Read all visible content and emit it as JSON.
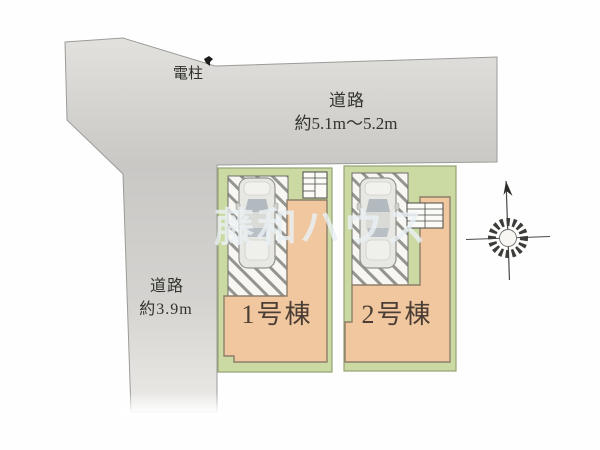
{
  "plan": {
    "type": "real-estate-site-plan",
    "watermark": {
      "text": "藤和ハウス"
    },
    "roads": {
      "top": {
        "label": "道路",
        "width_label": "約5.1m〜5.2m"
      },
      "left": {
        "label": "道路",
        "width_label": "約3.9m"
      }
    },
    "landmarks": {
      "utility_pole": {
        "label": "電柱"
      }
    },
    "lots": [
      {
        "name": "1号棟",
        "features": [
          "building",
          "parking-space",
          "car",
          "entrance-steps"
        ]
      },
      {
        "name": "2号棟",
        "features": [
          "building",
          "parking-space",
          "car",
          "entrance-steps"
        ]
      }
    ],
    "compass": {
      "icon": "north-compass"
    },
    "colors": {
      "road_gray": "#d2d1ce",
      "lot_green": "#cbd9a2",
      "building_tan": "#f0c79e",
      "parking_white": "#f7f6f3",
      "label_text": "#32322f",
      "lot_label_text": "#4c3e35",
      "watermark_tint": "#e9f0f4"
    }
  }
}
